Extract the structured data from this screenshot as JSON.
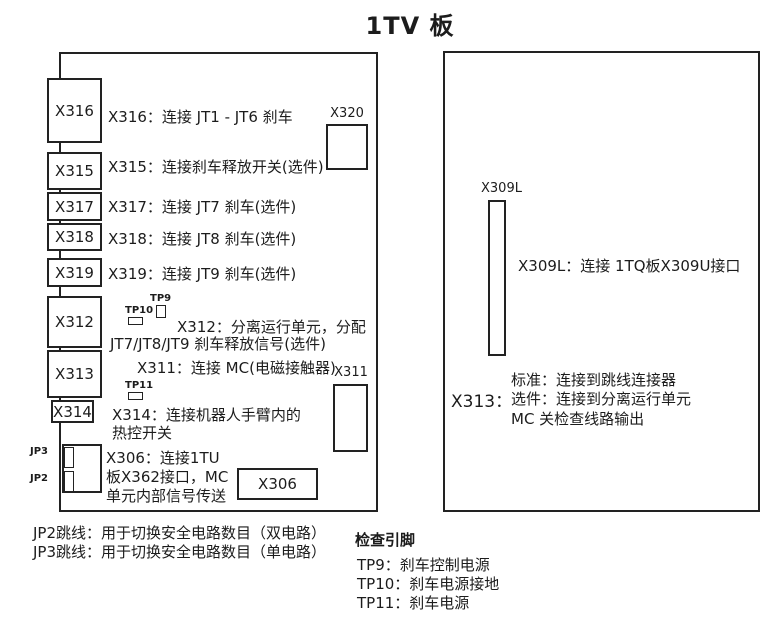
{
  "title": "1TV 板",
  "left": {
    "slots": [
      {
        "label": "X316",
        "desc": "X316：连接 JT1 - JT6 刹车"
      },
      {
        "label": "X315",
        "desc": "X315：连接刹车释放开关(选件)"
      },
      {
        "label": "X317",
        "desc": "X317：连接 JT7 刹车(选件)"
      },
      {
        "label": "X318",
        "desc": "X318：连接 JT8 刹车(选件)"
      },
      {
        "label": "X319",
        "desc": "X319：连接 JT9 刹车(选件)"
      }
    ],
    "x312": {
      "label": "X312",
      "desc_line1": "X312：分离运行单元，分配",
      "desc_line2": "JT7/JT8/JT9 刹车释放信号(选件)"
    },
    "x313_label": "X313",
    "x311_desc": "X311：连接 MC(电磁接触器)",
    "x314": {
      "label": "X314",
      "desc_line1": "X314：连接机器人手臂内的",
      "desc_line2": "热控开关"
    },
    "x306": {
      "label": "X306",
      "desc_line1": "X306：连接1TU",
      "desc_line2": "板X362接口，MC",
      "desc_line3": "单元内部信号传送"
    },
    "x320_label": "X320",
    "x311_label": "X311",
    "jp3_label": "JP3",
    "jp2_label": "JP2",
    "tp9_label": "TP9",
    "tp10_label": "TP10",
    "tp11_label": "TP11"
  },
  "right": {
    "x309l_label": "X309L",
    "x309l_desc": "X309L：连接 1TQ板X309U接口",
    "x313_label": "X313：",
    "x313_lines": [
      "标准：连接到跳线连接器",
      "选件：连接到分离运行单元",
      "MC 关检查线路输出"
    ]
  },
  "footnotes": {
    "jp2": "JP2跳线：用于切换安全电路数目（双电路）",
    "jp3": "JP3跳线：用于切换安全电路数目（单电路）",
    "check_pins_title": "检查引脚",
    "tp9": "TP9：刹车控制电源",
    "tp10": "TP10：刹车电源接地",
    "tp11": "TP11：刹车电源"
  },
  "colors": {
    "line": "#222222",
    "text": "#1c1c1c",
    "background": "#ffffff"
  }
}
